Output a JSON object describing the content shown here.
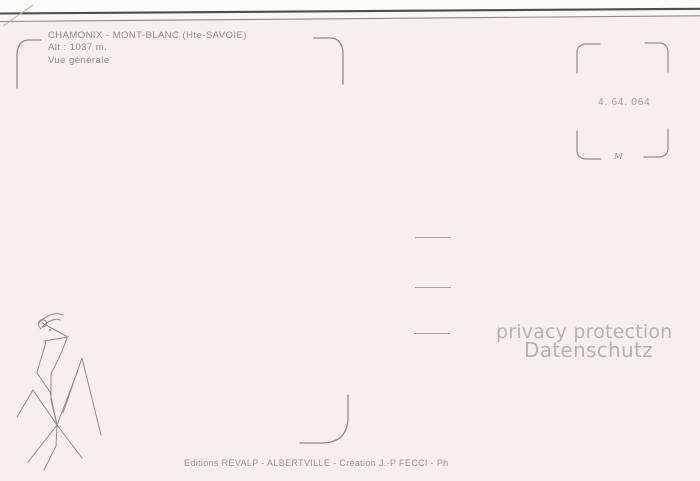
{
  "postcard": {
    "colors": {
      "paper": "#f3f1ea",
      "paper-above-edge": "#fcfcfa",
      "paper-edge-gap": "#f8f7f1",
      "ink": "#8d8b83",
      "imprint-ink": "#98958d",
      "mark-ink": "#8e8c84",
      "edge-dark": "#4f4e44",
      "edge-light": "#8b8b80",
      "watermark": "#b5b3b0"
    },
    "title_block": {
      "line1": "CHAMONIX - MONT-BLANC (Hte-SAVOIE)",
      "line2": "Alt : 1037 m.",
      "line3": "Vue générale"
    },
    "stamp_box": {
      "reference_number": "4. 64. 064",
      "letter_mark": "M"
    },
    "watermark": {
      "line1": "privacy protection",
      "line2": "Datenschutz"
    },
    "imprint": "Editions REVALP - ALBERTVILLE - Création J.-P FECCI - Ph"
  }
}
